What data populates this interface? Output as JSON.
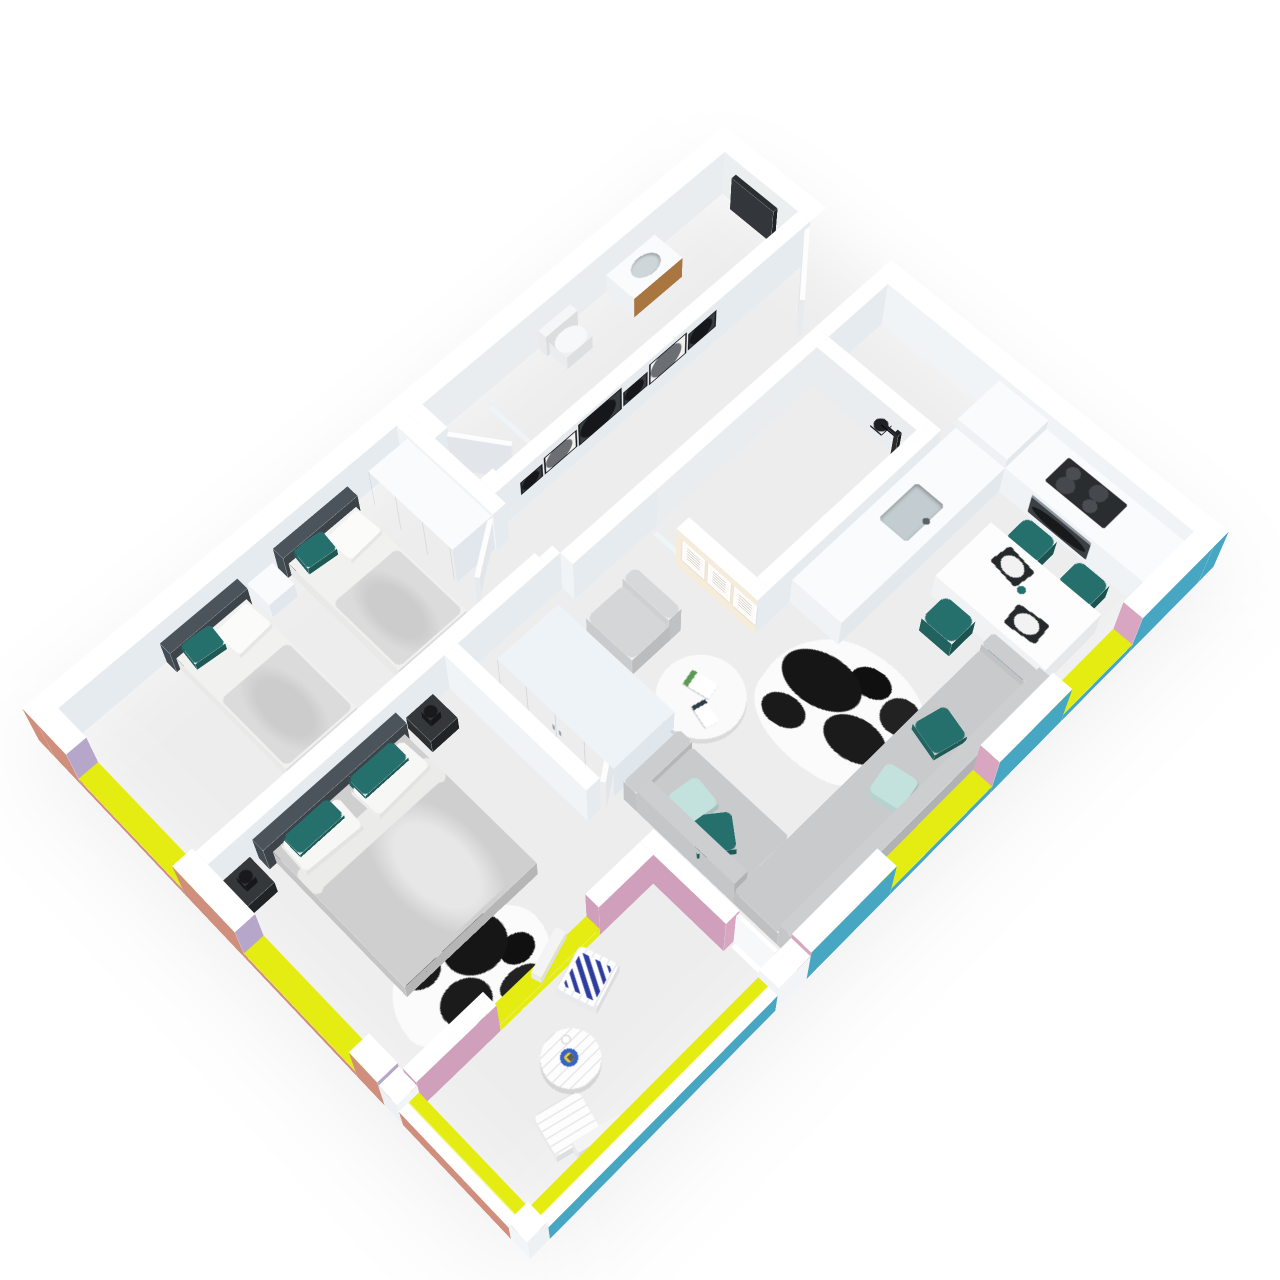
{
  "page": {
    "background": "#ffffff",
    "description": "Isometric 3D rendering of a two-bedroom apartment floor plan with open living-kitchen area and terrace"
  },
  "colors": {
    "exterior_salmon": "#cf8f7c",
    "exterior_teal": "#47a6c2",
    "accent_yellow": "#e4ec12",
    "interior_pink": "#cf9fbc",
    "pier_pink": "#d8a6c0",
    "pier_lilac": "#b6a6c9",
    "wall_top": "#ffffff",
    "wall_face_light": "#f1f4f7",
    "wall_face_dark": "#e6ebf0",
    "floor_wood": "#cfa87f",
    "floor_wood_dark": "#b98f67",
    "floor_tile": "#90999e",
    "floor_marble": "#eef0f1",
    "marble_vein": "#a8b2b8",
    "headboard_slate": "#4b545b",
    "bedding_white": "#f1f1f0",
    "blanket_gray": "#cfcfd0",
    "textile_teal": "#256f6c",
    "textile_mint": "#c3e2de",
    "sofa_gray": "#c9cacc",
    "armchair_gray": "#d4d6d8",
    "furniture_white": "#fafbfc",
    "wardrobe_blue_white": "#eef3f7",
    "appliance_dark": "#2a2d30",
    "appliance_steel": "#8d969c",
    "wood_drawer": "#a9763f",
    "frame_black": "#1c1f22",
    "frame_white": "#fcfbf9",
    "gallery_wall_cream": "#f6ecdb",
    "terrace_navy": "#2e3d9d",
    "plate_blue": "#3763c4",
    "plate_yellow": "#e8c92e",
    "glass": "rgba(222,238,244,0.78)",
    "door_white": "#fdfdfe",
    "shadow": "rgba(0,0,0,0.07)"
  },
  "rooms": [
    {
      "id": "hallway",
      "floor": "wood",
      "features": [
        "entrance-door",
        "gallery-wall-frames"
      ]
    },
    {
      "id": "bathroom",
      "floor": "marble",
      "fixtures": [
        "towel-ladder",
        "vanity-with-wood-drawer",
        "sink",
        "toilet",
        "glass-shower-screen"
      ]
    },
    {
      "id": "shower-room",
      "floor": "marble",
      "fixtures": [
        "black-rain-shower",
        "glass-door",
        "marble-walls"
      ]
    },
    {
      "id": "kitchen",
      "floor": "wood",
      "fixtures": [
        "l-shaped-white-counter",
        "inset-sink",
        "black-cooktop",
        "oven",
        "tall-cabinet",
        "marble-worktop"
      ]
    },
    {
      "id": "living-dining",
      "floor": "wood",
      "furniture": [
        "white-dining-table",
        "teal-dining-chairs",
        "gray-corner-sofa",
        "sofa-pillows",
        "round-coffee-table",
        "gray-armchair",
        "cowhide-rug",
        "light-wardrobe",
        "text-art-frames"
      ]
    },
    {
      "id": "bedroom-single",
      "floor": "wood",
      "furniture": [
        "single-bed",
        "single-bed",
        "white-nightstand",
        "white-wardrobe",
        "window"
      ]
    },
    {
      "id": "bedroom-master",
      "floor": "wood",
      "furniture": [
        "double-bed",
        "black-nightstand",
        "black-nightstand",
        "black-table-lamps",
        "cowhide-rug",
        "window"
      ]
    },
    {
      "id": "terrace",
      "floor": "tile",
      "furniture": [
        "white-bistro-table",
        "white-folding-chair",
        "white-folding-chair",
        "navy-chevron-cushion",
        "blue-plate"
      ]
    }
  ],
  "counts": {
    "gallery_frames": 6,
    "text_art_frames": 3,
    "dining_chairs": 4,
    "sofa_pillows": 4,
    "single_beds": 2,
    "terrace_chairs": 2,
    "windows_salmon_side": 2,
    "windows_teal_side": 2
  },
  "textiles": {
    "bed_accent_pillows": "teal",
    "sofa_pillow_colors": [
      "teal",
      "mint"
    ],
    "terrace_cushion_pattern": "navy-white-chevron"
  }
}
